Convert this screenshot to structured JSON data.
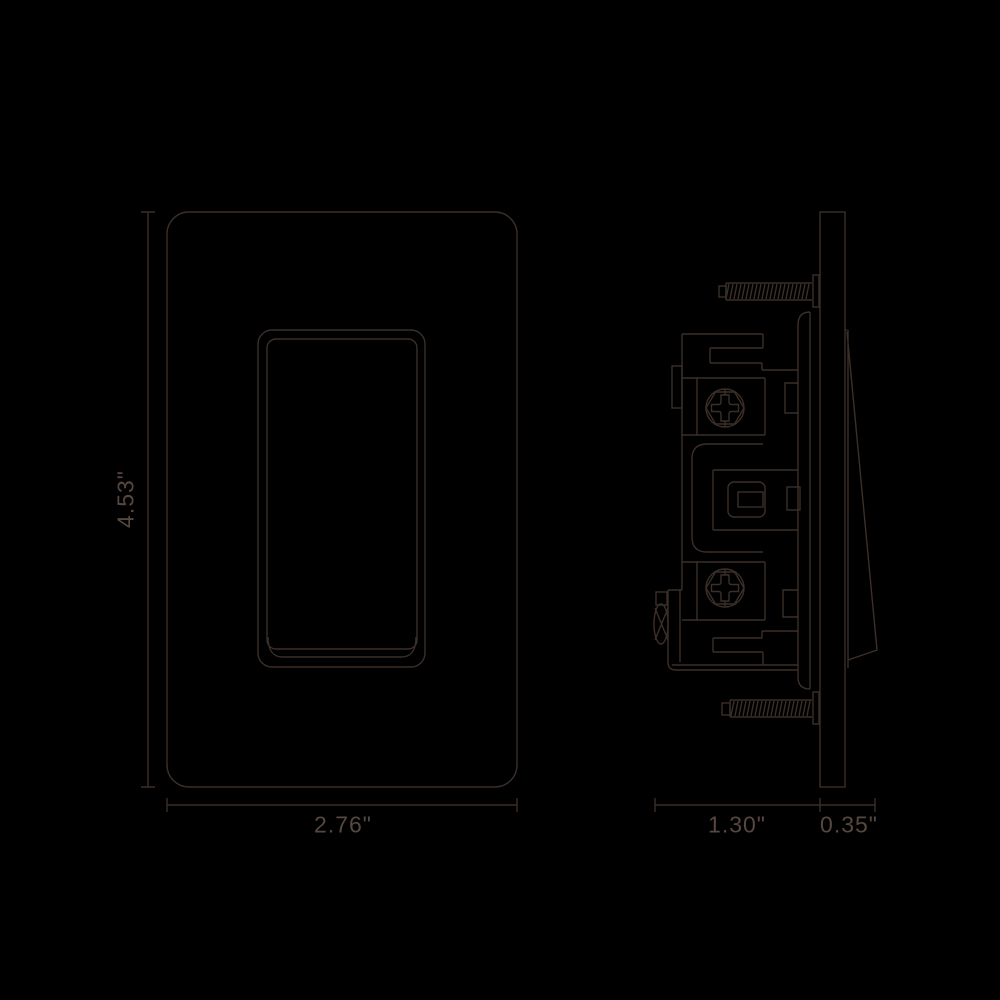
{
  "theme": {
    "background": "#000000",
    "line_color": "#3b2f29",
    "text_color": "#564840"
  },
  "diagram": {
    "front_view": {
      "height_dim": "4.53\"",
      "width_dim": "2.76\""
    },
    "side_view": {
      "body_depth_dim": "1.30\"",
      "paddle_depth_dim": "0.35\""
    }
  }
}
